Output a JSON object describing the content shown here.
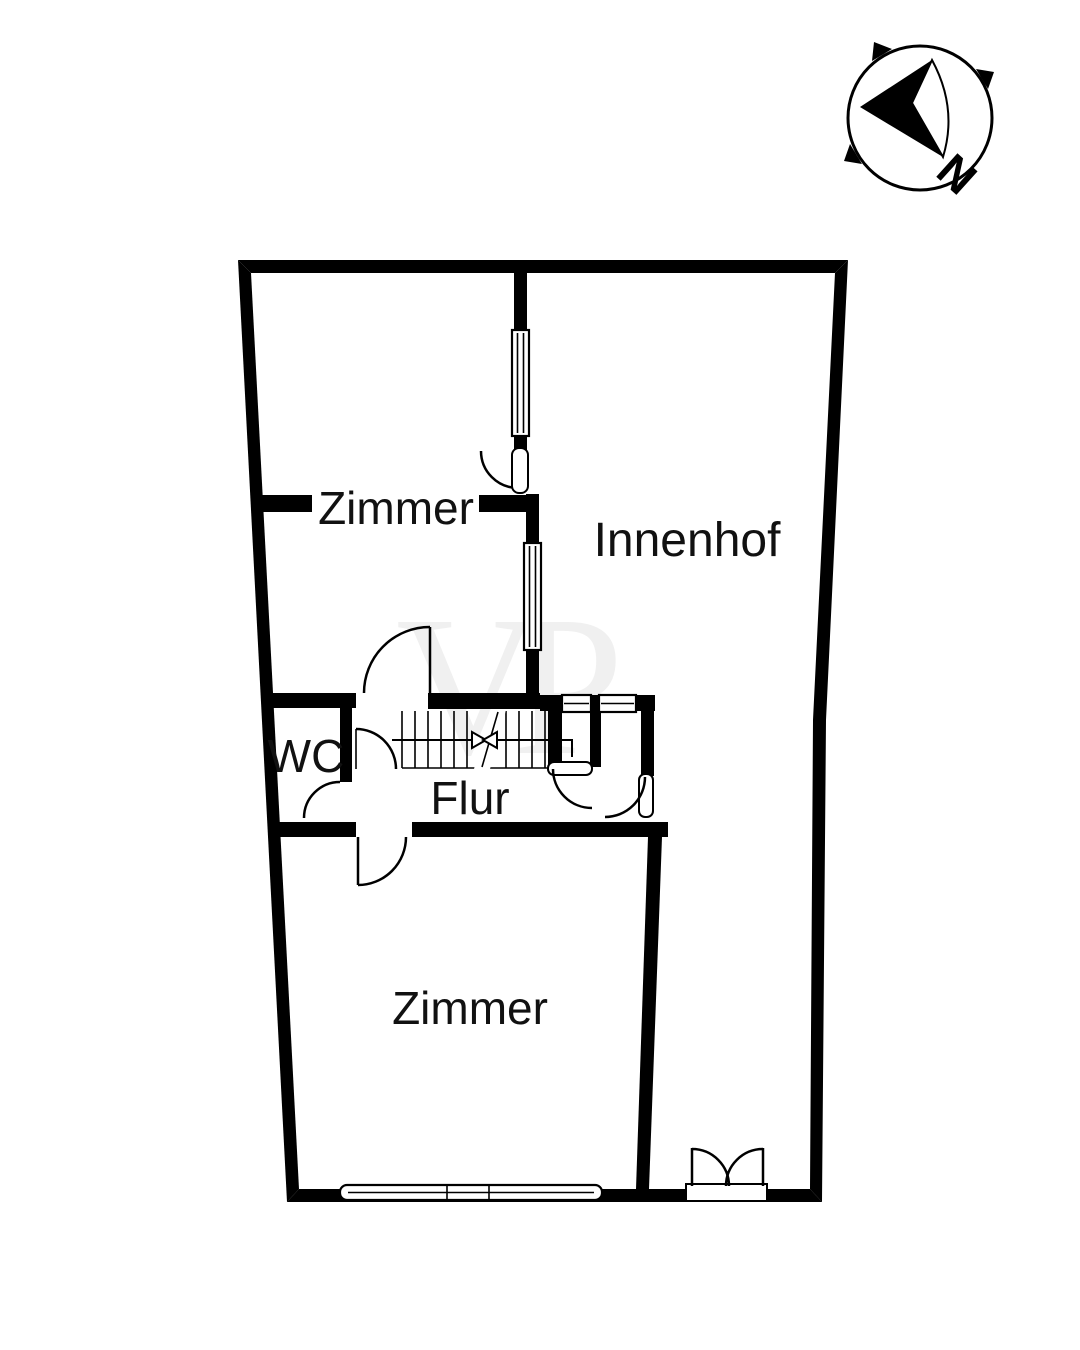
{
  "document": {
    "kind": "floor-plan"
  },
  "colors": {
    "ink": "#000000",
    "background": "#ffffff",
    "watermark_gray": "#f0f0f0"
  },
  "watermark": {
    "text": "VP"
  },
  "compass": {
    "north_label": "N"
  },
  "rooms": [
    {
      "id": "zimmer-top",
      "label": "Zimmer"
    },
    {
      "id": "innenhof",
      "label": "Innenhof"
    },
    {
      "id": "wc",
      "label": "WC"
    },
    {
      "id": "flur",
      "label": "Flur"
    },
    {
      "id": "zimmer-bottom",
      "label": "Zimmer"
    }
  ]
}
